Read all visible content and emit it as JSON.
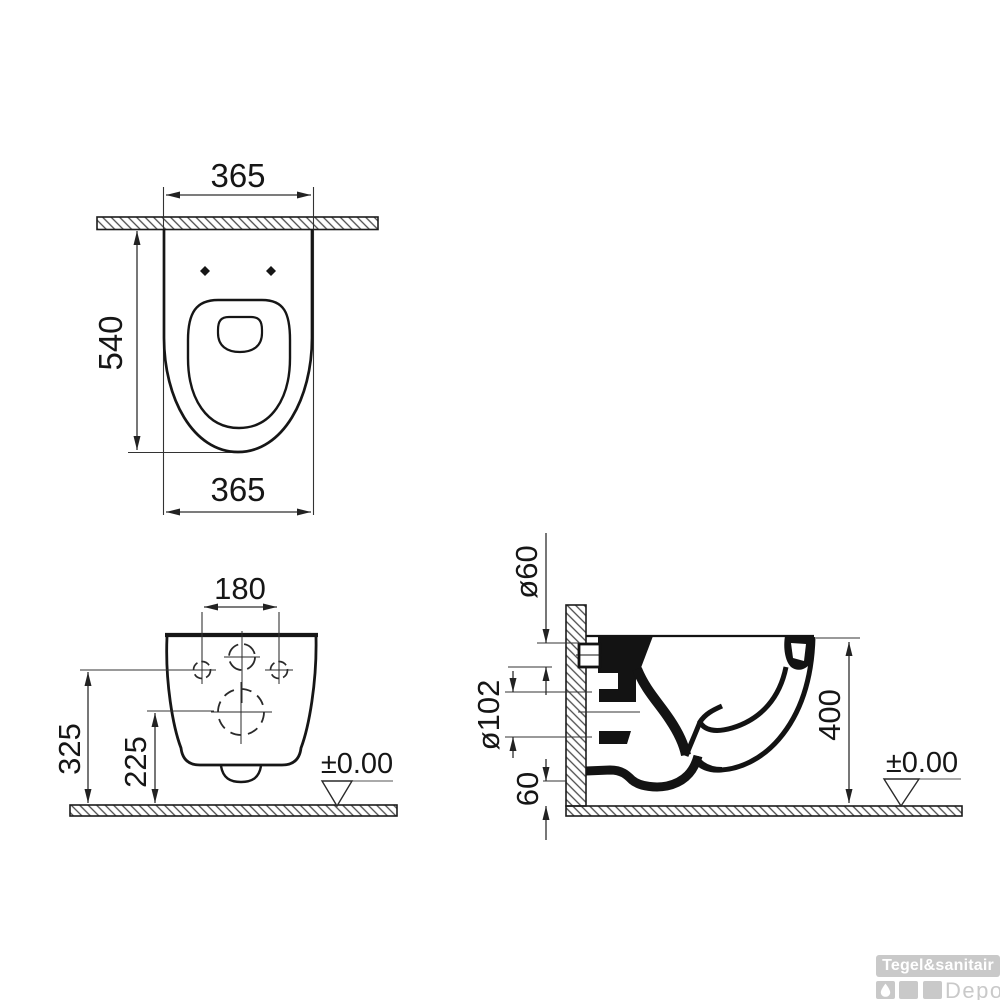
{
  "views": {
    "top": {
      "width_top": "365",
      "depth": "540",
      "width_bottom": "365"
    },
    "front": {
      "bolt_spacing": "180",
      "fixing_height": "325",
      "outlet_height": "225",
      "floor_level": "±0.00"
    },
    "side": {
      "inlet_diameter": "ø60",
      "outlet_diameter": "ø102",
      "trap_clearance": "60",
      "rim_height": "400",
      "floor_level": "±0.00"
    }
  },
  "watermark": {
    "brand": "Tegel&sanitair",
    "name": "Depot"
  },
  "colors": {
    "line": "#161616",
    "dim_line": "#333333",
    "watermark": "#c9c9c9"
  }
}
